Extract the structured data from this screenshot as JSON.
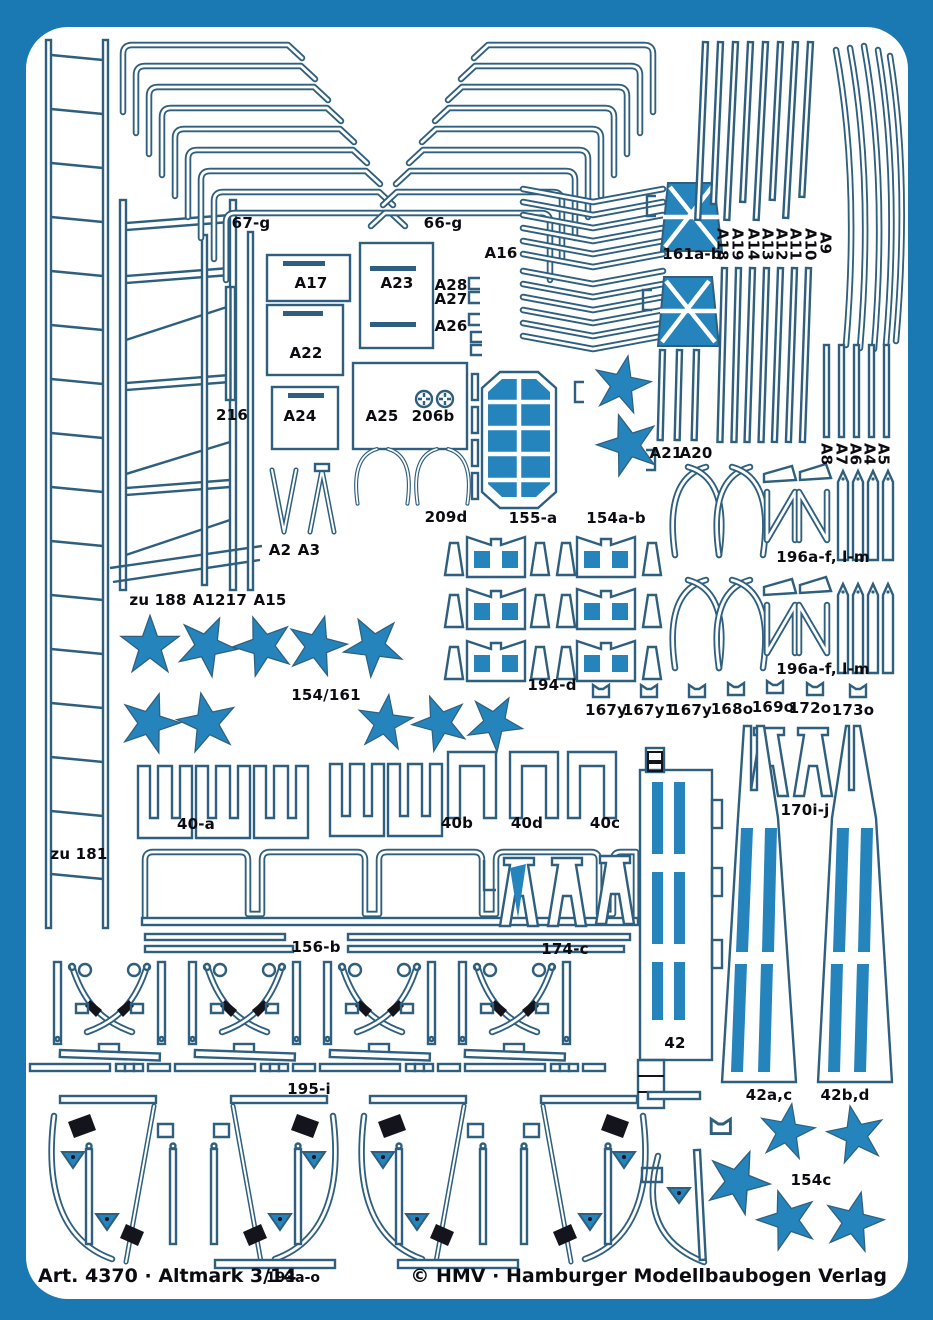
{
  "sheet": {
    "kind": "photo-etch parts sheet",
    "footer": {
      "article": "Art. 4370 · Altmark 3/14",
      "center_part": "193a-o",
      "publisher": "© HMV · Hamburger Modellbaubogen Verlag"
    }
  },
  "colors": {
    "frame_blue": "#1a78b2",
    "outline_blue": "#2e5f7e",
    "part_fill_blue": "#2484bb",
    "detail_black": "#14141c",
    "label_text": "#0b0b12",
    "sheet_white": "#ffffff"
  },
  "part_labels": [
    {
      "text": "67-g"
    },
    {
      "text": "66-g"
    },
    {
      "text": "A16"
    },
    {
      "text": "161a-b"
    },
    {
      "text": "A18"
    },
    {
      "text": "A19"
    },
    {
      "text": "A14"
    },
    {
      "text": "A13"
    },
    {
      "text": "A12"
    },
    {
      "text": "A11"
    },
    {
      "text": "A10"
    },
    {
      "text": "A9"
    },
    {
      "text": "A17"
    },
    {
      "text": "A23"
    },
    {
      "text": "A28"
    },
    {
      "text": "A27"
    },
    {
      "text": "A26"
    },
    {
      "text": "A22"
    },
    {
      "text": "216"
    },
    {
      "text": "A24"
    },
    {
      "text": "A25"
    },
    {
      "text": "206b"
    },
    {
      "text": "A21"
    },
    {
      "text": "A20"
    },
    {
      "text": "A8"
    },
    {
      "text": "A7"
    },
    {
      "text": "A6"
    },
    {
      "text": "A4"
    },
    {
      "text": "A5"
    },
    {
      "text": "209d"
    },
    {
      "text": "155-a"
    },
    {
      "text": "154a-b"
    },
    {
      "text": "A2"
    },
    {
      "text": "A3"
    },
    {
      "text": "zu 188"
    },
    {
      "text": "A1"
    },
    {
      "text": "217"
    },
    {
      "text": "A15"
    },
    {
      "text": "154/161"
    },
    {
      "text": "194-d"
    },
    {
      "text": "167y"
    },
    {
      "text": "167y1"
    },
    {
      "text": "167y"
    },
    {
      "text": "168o"
    },
    {
      "text": "169o"
    },
    {
      "text": "172o"
    },
    {
      "text": "173o"
    },
    {
      "text": "196a-f, l-m"
    },
    {
      "text": "196a-f, l-m"
    },
    {
      "text": "170i-j"
    },
    {
      "text": "40-a"
    },
    {
      "text": "40b"
    },
    {
      "text": "40d"
    },
    {
      "text": "40c"
    },
    {
      "text": "zu 181"
    },
    {
      "text": "156-b"
    },
    {
      "text": "174-c"
    },
    {
      "text": "42"
    },
    {
      "text": "195-i"
    },
    {
      "text": "42a,c"
    },
    {
      "text": "42b,d"
    },
    {
      "text": "154c"
    }
  ]
}
